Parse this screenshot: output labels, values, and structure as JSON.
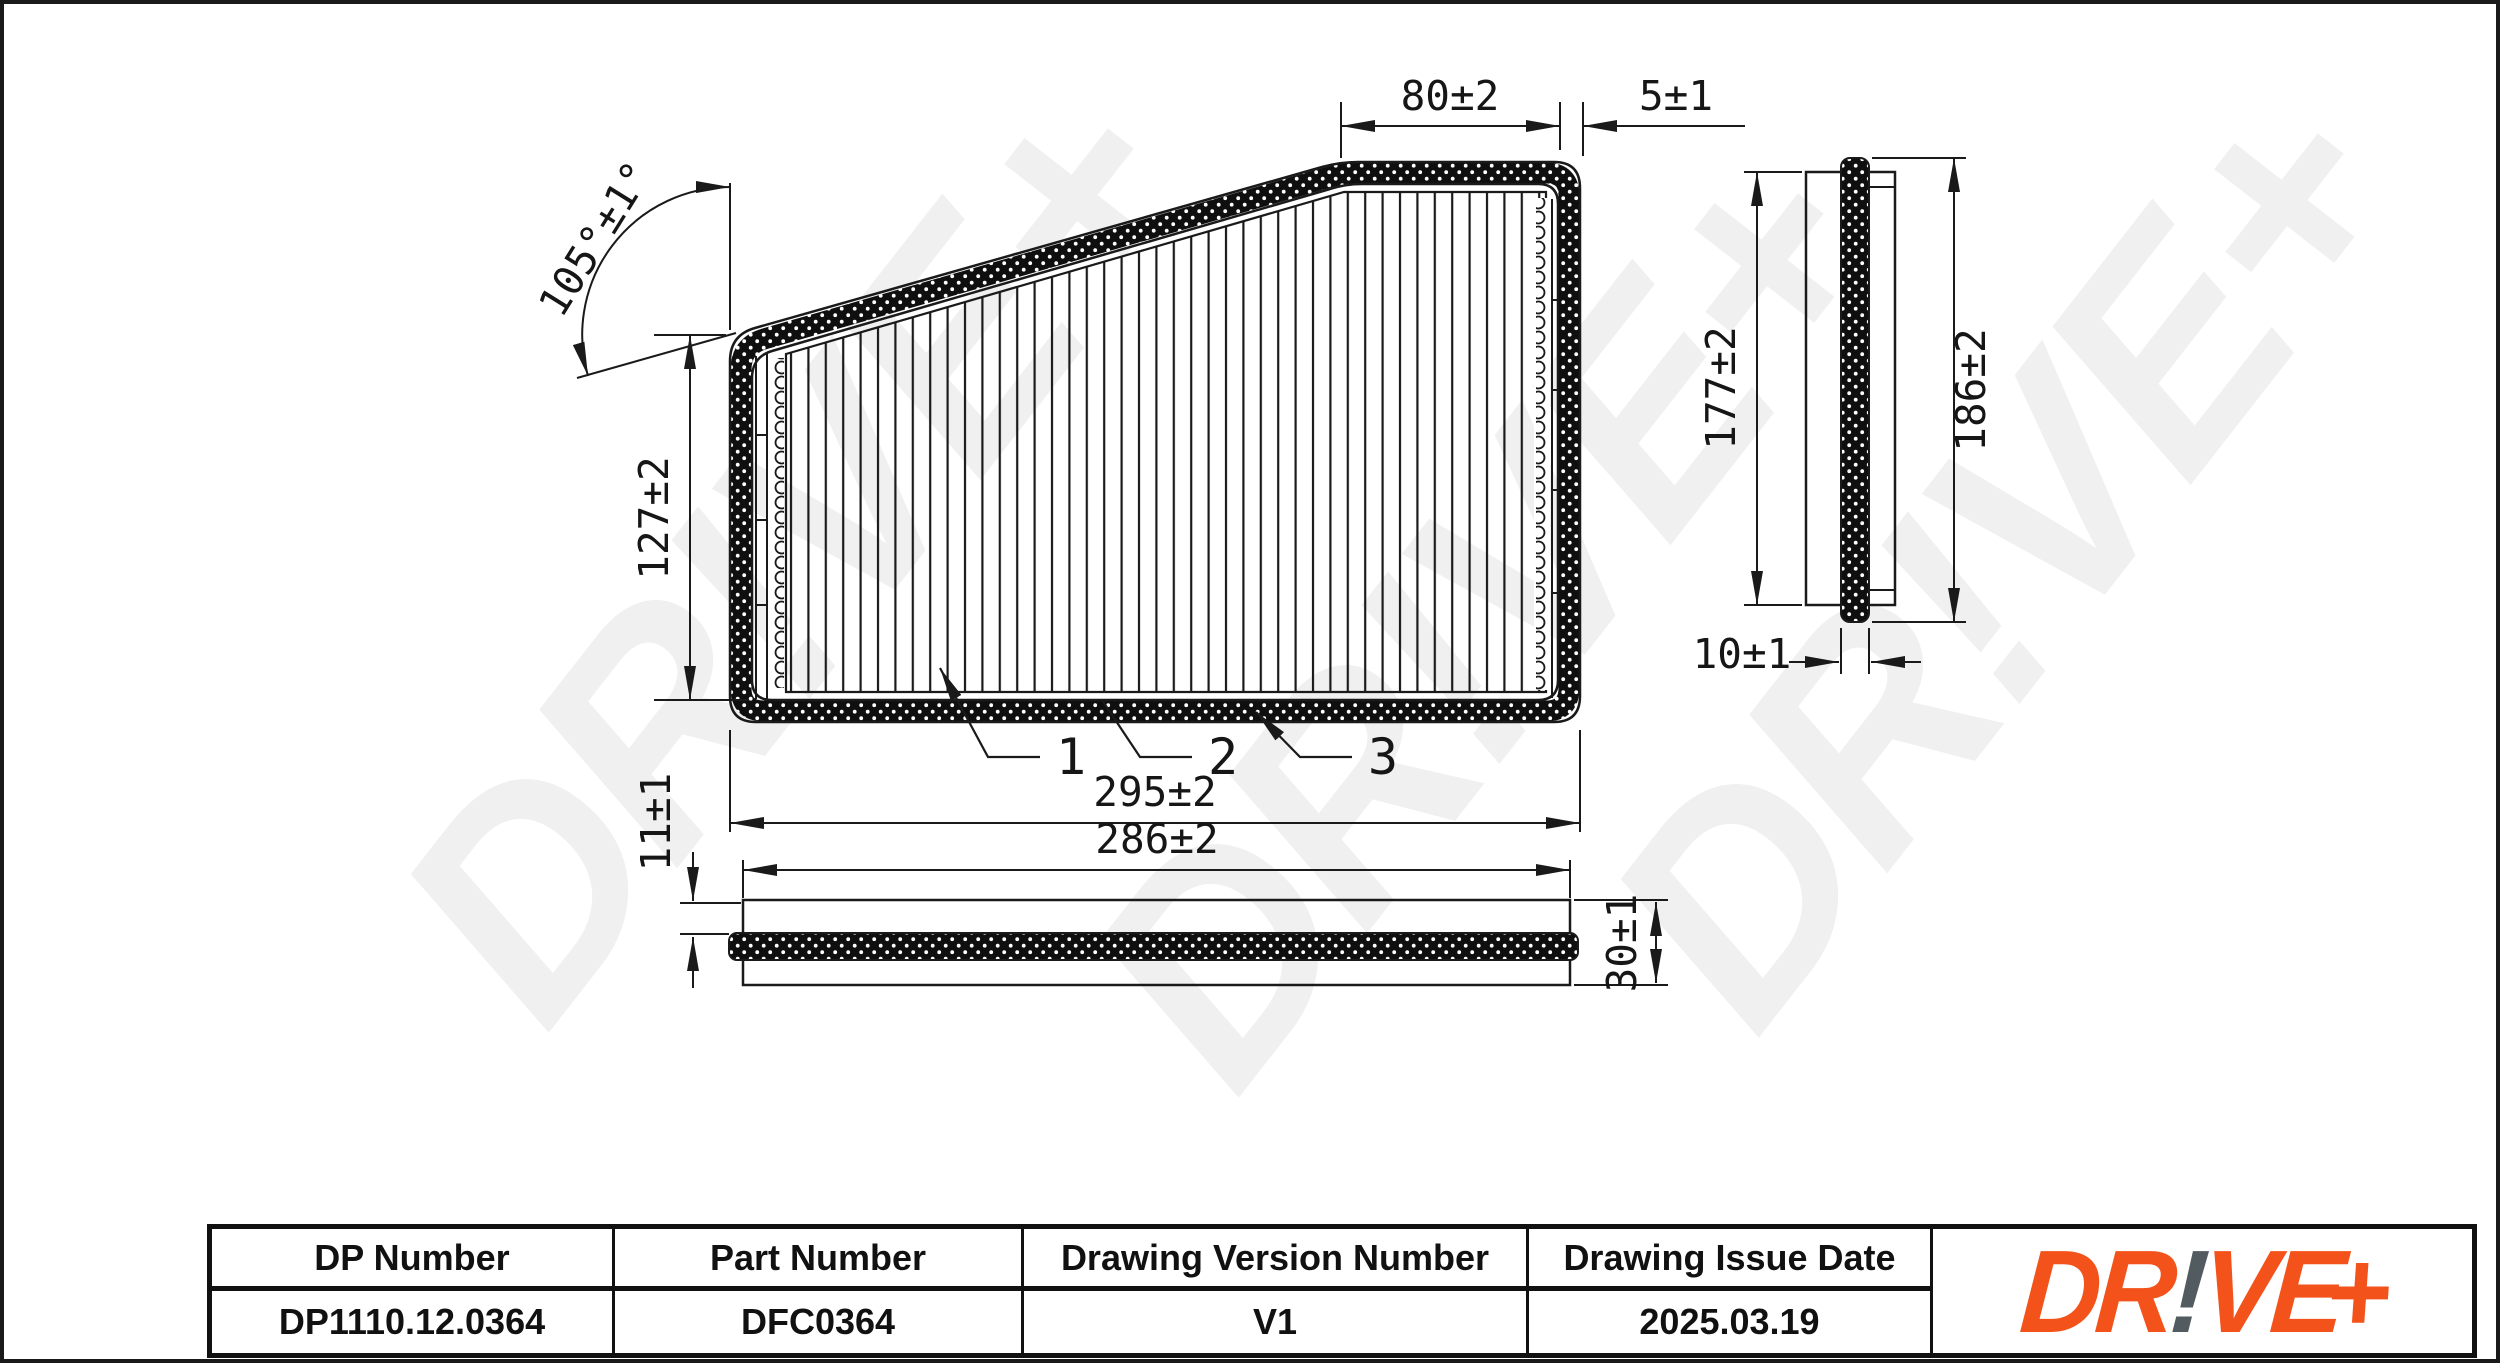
{
  "colors": {
    "accent-orange": "#F3531B",
    "logo-gray": "#515B60",
    "line-black": "#1a1a1a",
    "watermark": "#f0f0f0"
  },
  "watermark": {
    "text": "DR!VE+"
  },
  "front_view": {
    "dim_top_width": "80±2",
    "dim_seal_offset": "5±1",
    "dim_angle": "105°±1°",
    "dim_left_height": "127±2",
    "dim_overall_width": "295±2",
    "label_media": "1",
    "label_frame": "2",
    "label_seal": "3"
  },
  "bottom_view": {
    "dim_inner_width": "286±2",
    "dim_seal_drop": "11±1",
    "dim_thickness": "30±1"
  },
  "side_view": {
    "dim_frame_height": "177±2",
    "dim_overall_height": "186±2",
    "dim_thickness": "10±1"
  },
  "title_block": {
    "columns": [
      {
        "label": "DP Number",
        "value": "DP1110.12.0364"
      },
      {
        "label": "Part Number",
        "value": "DFC0364"
      },
      {
        "label": "Drawing Version Number",
        "value": "V1"
      },
      {
        "label": "Drawing Issue Date",
        "value": "2025.03.19"
      }
    ],
    "logo": {
      "part_dr": "DR",
      "part_bang": "!",
      "part_ve": "VE",
      "part_plus": "+"
    }
  }
}
